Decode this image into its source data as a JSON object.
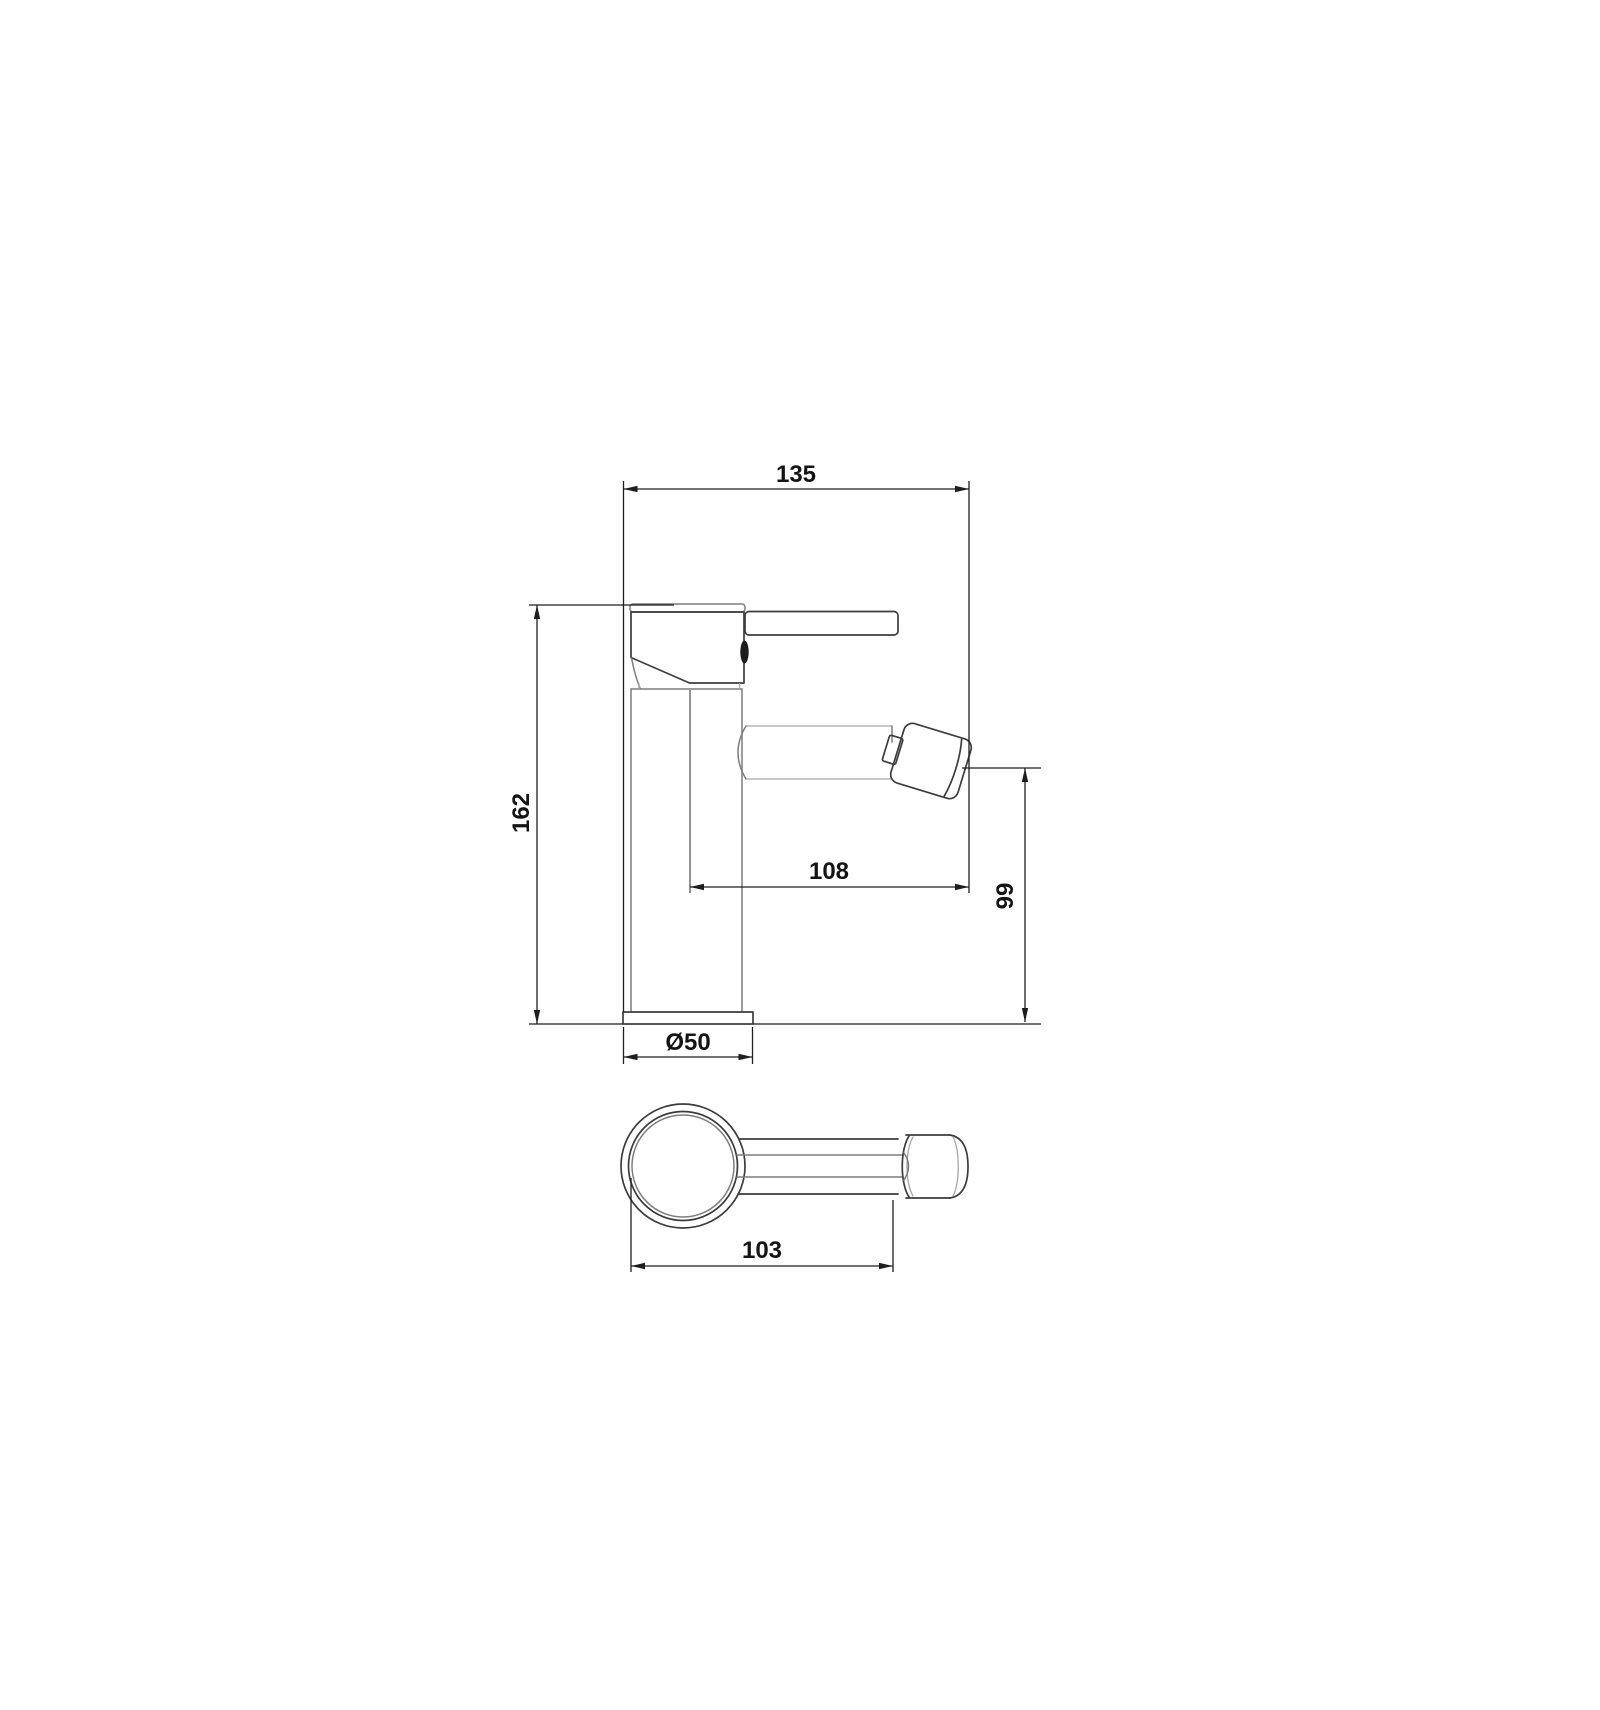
{
  "drawing": {
    "dimensions": {
      "overall_width": "135",
      "overall_height": "162",
      "spout_reach": "108",
      "outlet_height": "99",
      "base_diameter": "Ø50",
      "top_view_length": "103"
    },
    "colors": {
      "background": "#ffffff",
      "outline": "#3c3c3c",
      "dimension": "#1e1e1e"
    }
  }
}
